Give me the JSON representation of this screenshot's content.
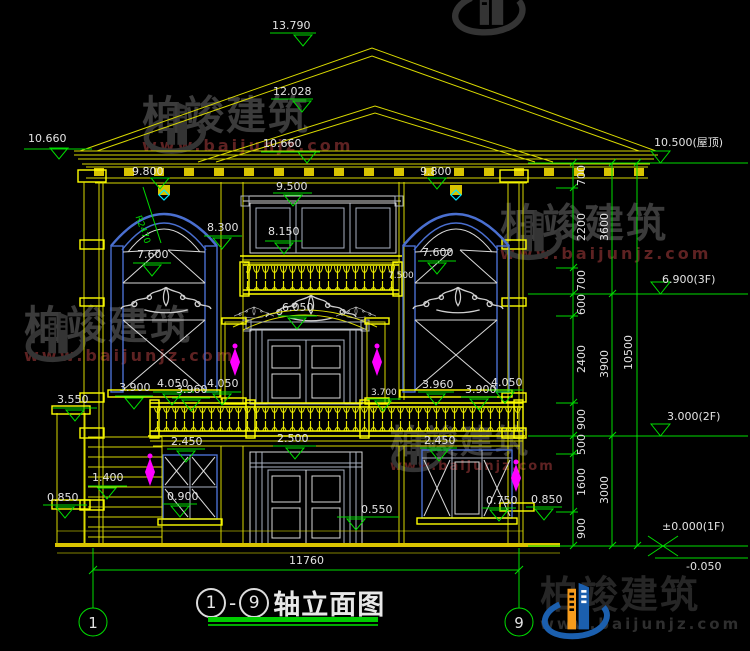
{
  "title": {
    "axis_start": "1",
    "axis_end": "9",
    "dash": "-",
    "name": "轴立面图"
  },
  "axes": {
    "left_bubble": "1",
    "right_bubble": "9"
  },
  "watermark": {
    "brand": "柏竣建筑",
    "url": "www.baijunjz.com"
  },
  "levels": {
    "peak": "13.790",
    "ridge2": "12.028",
    "eave_left": "10.660",
    "eave_mid": "10.660",
    "roof": "10.500(屋顶)",
    "arch_left": "9.800",
    "arch_right": "9.800",
    "balc3_top": "9.500",
    "m8300": "8.300",
    "balc3_floor": "8.150",
    "win_left": "7.600",
    "win_right": "7.600",
    "m7500": "7.500",
    "f3": "6.900(3F)",
    "door2": "6.050",
    "l3900": "3.900",
    "l4050a": "4.050",
    "l3960": "3.960",
    "l4050b": "4.050",
    "m3550": "3.550",
    "r3700": "3.700",
    "r3960": "3.960",
    "r3900": "3.900",
    "r4050": "4.050",
    "f2": "3.000(2F)",
    "l2450": "2.450",
    "m2500": "2.500",
    "r2450": "2.450",
    "m1400": "1.400",
    "m0900": "0.900",
    "l0850": "0.850",
    "m0550": "0.550",
    "r0750": "0.750",
    "r0850": "0.850",
    "f1": "±0.000(1F)",
    "ground": "-0.050"
  },
  "dims": {
    "right_col1": [
      "700",
      "2200",
      "700",
      "600",
      "2400",
      "900",
      "500",
      "1600",
      "900"
    ],
    "right_col2": [
      "3600",
      "3900",
      "3000"
    ],
    "right_col3": [
      "10500"
    ],
    "bottom_width": "11760",
    "radius": "R2470"
  },
  "colors": {
    "line_yellow": "#d9d900",
    "dim_green": "#00dd00",
    "frame_blue": "#4a6fd0",
    "ornament_magenta": "#ff00ff",
    "accent_cyan": "#00e5ff",
    "watermark_url_red": "#5e2222"
  }
}
